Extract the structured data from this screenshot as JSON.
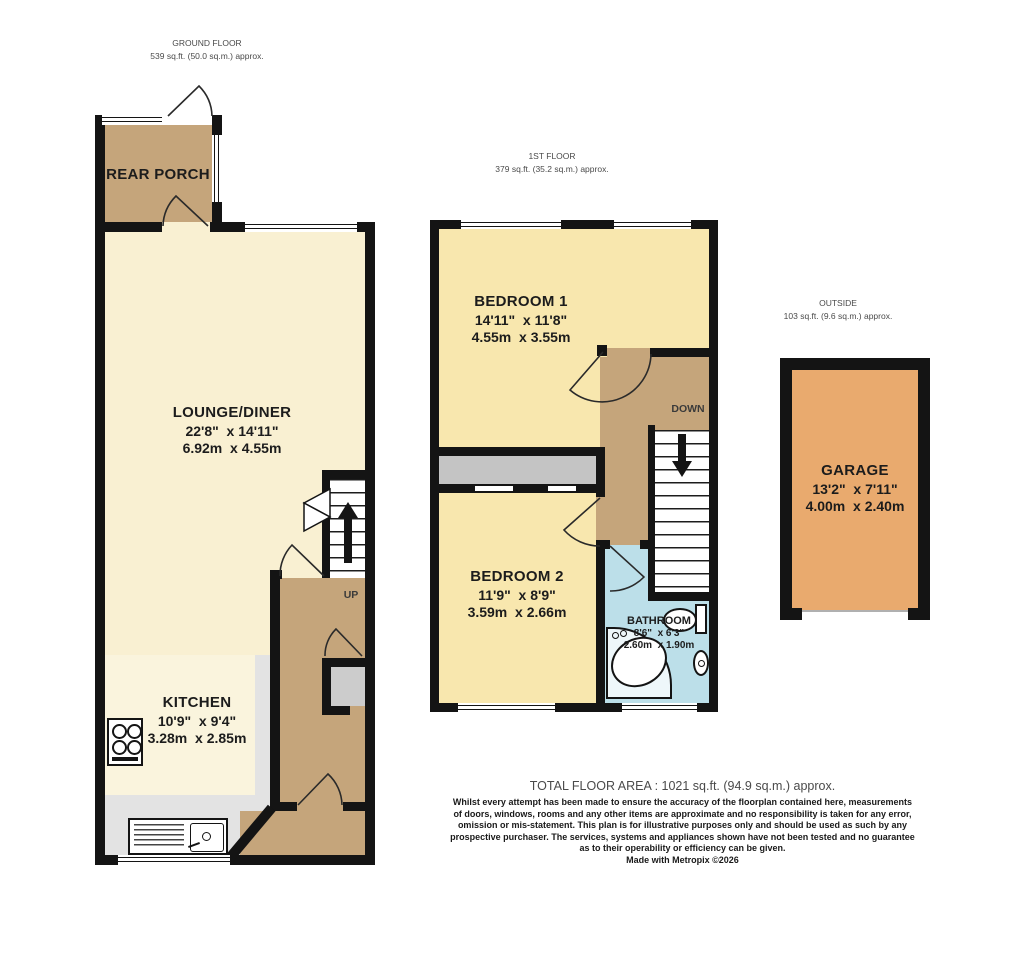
{
  "floors": {
    "ground": {
      "name": "GROUND FLOOR",
      "area": "539 sq.ft. (50.0 sq.m.) approx."
    },
    "first": {
      "name": "1ST FLOOR",
      "area": "379 sq.ft. (35.2 sq.m.) approx."
    },
    "outside": {
      "name": "OUTSIDE",
      "area": "103 sq.ft. (9.6 sq.m.) approx."
    }
  },
  "rooms": {
    "rear_porch": {
      "name": "REAR PORCH"
    },
    "lounge": {
      "name": "LOUNGE/DINER",
      "imperial": "22'8\"  x 14'11\"",
      "metric": "6.92m  x 4.55m"
    },
    "kitchen": {
      "name": "KITCHEN",
      "imperial": "10'9\"  x 9'4\"",
      "metric": "3.28m  x 2.85m"
    },
    "bedroom1": {
      "name": "BEDROOM 1",
      "imperial": "14'11\"  x 11'8\"",
      "metric": "4.55m  x 3.55m"
    },
    "bedroom2": {
      "name": "BEDROOM 2",
      "imperial": "11'9\"  x 8'9\"",
      "metric": "3.59m  x 2.66m"
    },
    "bathroom": {
      "name": "BATHROOM",
      "imperial": "8'6\"  x 6'3\"",
      "metric": "2.60m  x 1.90m"
    },
    "garage": {
      "name": "GARAGE",
      "imperial": "13'2\"  x 7'11\"",
      "metric": "4.00m  x 2.40m"
    }
  },
  "stairs": {
    "up": "UP",
    "down": "DOWN"
  },
  "footer": {
    "total": "TOTAL FLOOR AREA : 1021 sq.ft. (94.9 sq.m.) approx.",
    "disclaimer_lines": [
      "Whilst every attempt has been made to ensure the accuracy of the floorplan contained here, measurements",
      "of doors, windows, rooms and any other items are approximate and no responsibility is taken for any error,",
      "omission or mis-statement. This plan is for illustrative purposes only and should be used as such by any",
      "prospective purchaser. The services, systems and appliances shown have not been tested and no guarantee",
      "as to their operability or efficiency can be given."
    ],
    "credit": "Made with Metropix ©2026"
  },
  "colors": {
    "wall": "#141414",
    "porch_hall_brown": "#c5a57b",
    "lounge_cream": "#f9f0d2",
    "kitchen_cream": "#faf4dd",
    "kitchen_gray": "#e3e3e3",
    "bedroom_yellow": "#f8e7ae",
    "bathroom_blue": "#bcdfe9",
    "garage_orange": "#e9aa6e",
    "wardrobe_gray": "#c4c4c4"
  }
}
